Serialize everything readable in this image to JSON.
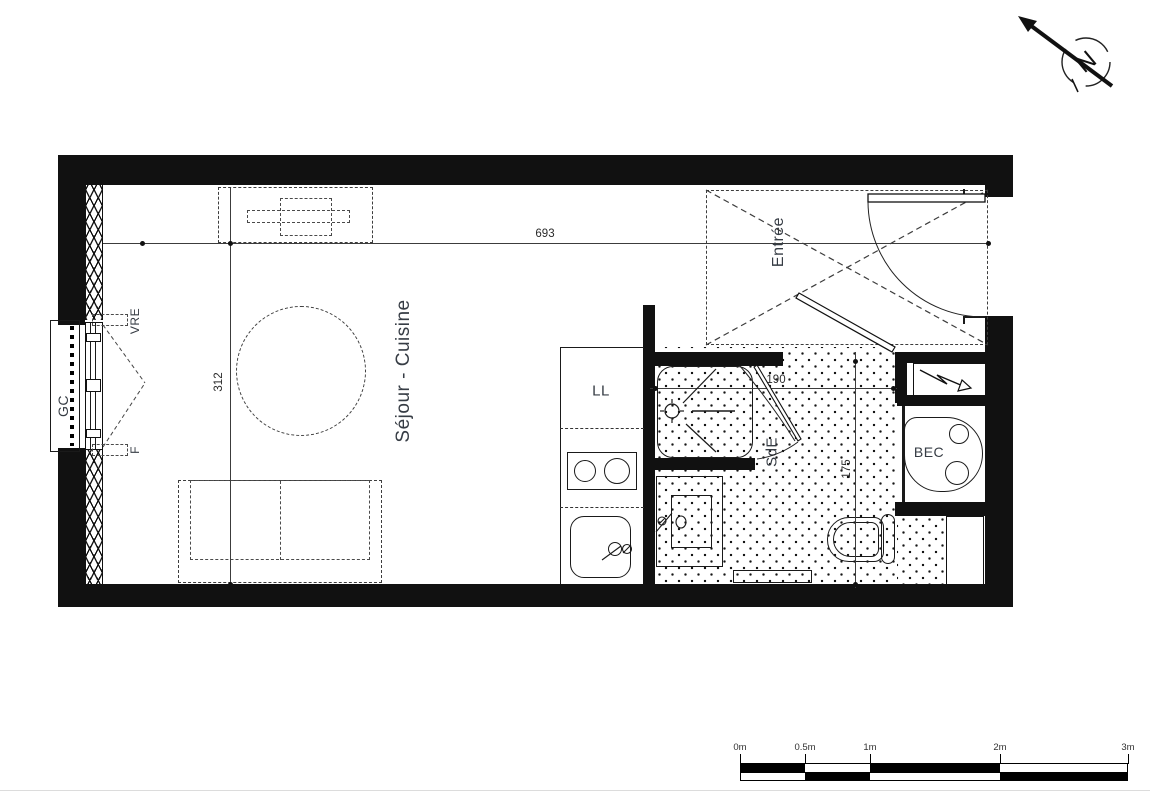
{
  "plan": {
    "rooms": {
      "living_kitchen": "Séjour - Cuisine",
      "entrance": "Entrée",
      "bathroom": "SdE"
    },
    "fixtures": {
      "washing_machine": "LL",
      "water_heater": "BEC",
      "guardrail": "GC",
      "roller_shutter": "VRE",
      "window": "F"
    },
    "dimensions": {
      "total_width": "693",
      "living_depth": "312",
      "bathroom_width": "190",
      "bathroom_depth": "175"
    }
  },
  "compass": {
    "north": "N"
  },
  "scale_bar": {
    "labels": [
      "0m",
      "0.5m",
      "1m",
      "2m",
      "3m"
    ]
  },
  "colors": {
    "wall": "#111111",
    "label": "#363c44",
    "dimension": "#2a2a2a",
    "background": "#ffffff"
  }
}
